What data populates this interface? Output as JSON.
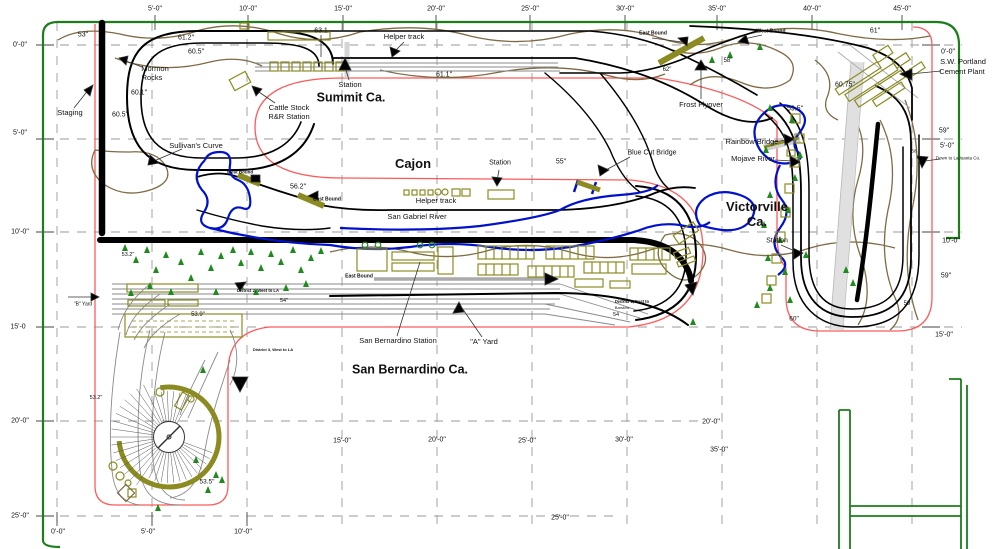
{
  "title": "Cajon Pass model railroad track plan",
  "canvas": {
    "width": 996,
    "height": 549
  },
  "colors": {
    "room_border_green": "#1b7e1b",
    "benchwork_edge_red": "#ff5a5a",
    "river_blue": "#0011cc",
    "contour_brown": "#7d6b45",
    "building_olive": "#8b8b22",
    "tree_green": "#1f8b1f",
    "track_black": "#000000",
    "grid_gray": "#909090"
  },
  "section_titles": [
    "Summit Ca.",
    "Cajon",
    "San Bernardino Ca.",
    "Victorville Ca."
  ],
  "labels": [
    {
      "id": "ruler-top-5",
      "text": "5'-0\"",
      "x": 155,
      "y": 9,
      "fs": 7
    },
    {
      "id": "ruler-top-10",
      "text": "10'-0\"",
      "x": 248,
      "y": 9,
      "fs": 7
    },
    {
      "id": "ruler-top-15",
      "text": "15'-0\"",
      "x": 343,
      "y": 9,
      "fs": 7
    },
    {
      "id": "ruler-top-20",
      "text": "20'-0\"",
      "x": 436,
      "y": 9,
      "fs": 7
    },
    {
      "id": "ruler-top-25",
      "text": "25'-0\"",
      "x": 530,
      "y": 9,
      "fs": 7
    },
    {
      "id": "ruler-top-30",
      "text": "30'-0\"",
      "x": 625,
      "y": 9,
      "fs": 7
    },
    {
      "id": "ruler-top-35",
      "text": "35'-0\"",
      "x": 717,
      "y": 9,
      "fs": 7
    },
    {
      "id": "ruler-top-40",
      "text": "40'-0\"",
      "x": 812,
      "y": 9,
      "fs": 7
    },
    {
      "id": "ruler-top-45",
      "text": "45'-0\"",
      "x": 902,
      "y": 9,
      "fs": 7
    },
    {
      "id": "ruler-left-0",
      "text": "0'-0\"",
      "x": 20,
      "y": 45,
      "fs": 7
    },
    {
      "id": "ruler-left-5",
      "text": "5'-0\"",
      "x": 20,
      "y": 133,
      "fs": 7
    },
    {
      "id": "ruler-left-10",
      "text": "10'-0\"",
      "x": 20,
      "y": 232,
      "fs": 7
    },
    {
      "id": "ruler-left-15",
      "text": "15'-0",
      "x": 18,
      "y": 327,
      "fs": 7
    },
    {
      "id": "ruler-left-20",
      "text": "20'-0\"",
      "x": 20,
      "y": 421,
      "fs": 7
    },
    {
      "id": "ruler-left-25",
      "text": "25'-0\"",
      "x": 20,
      "y": 516,
      "fs": 7
    },
    {
      "id": "ruler-bottom-0",
      "text": "0'-0\"",
      "x": 58,
      "y": 532,
      "fs": 7
    },
    {
      "id": "ruler-bottom-5",
      "text": "5'-0\"",
      "x": 148,
      "y": 532,
      "fs": 7
    },
    {
      "id": "ruler-bottom-10",
      "text": "10'-0\"",
      "x": 243,
      "y": 532,
      "fs": 7
    },
    {
      "id": "ruler-bottom-25",
      "text": "25'-0\"",
      "x": 560,
      "y": 518,
      "fs": 7
    },
    {
      "id": "ruler-mid-15",
      "text": "15'-0\"",
      "x": 342,
      "y": 441,
      "fs": 7
    },
    {
      "id": "ruler-mid-20",
      "text": "20'-0\"",
      "x": 437,
      "y": 440,
      "fs": 7
    },
    {
      "id": "ruler-mid-25",
      "text": "25'-0\"",
      "x": 527,
      "y": 441,
      "fs": 7
    },
    {
      "id": "ruler-mid-30",
      "text": "30'-0\"",
      "x": 624,
      "y": 440,
      "fs": 7
    },
    {
      "id": "ruler-mid-20b",
      "text": "20'-0\"",
      "x": 711,
      "y": 422,
      "fs": 7
    },
    {
      "id": "ruler-mid-35",
      "text": "35'-0\"",
      "x": 719,
      "y": 450,
      "fs": 7
    },
    {
      "id": "ruler-right-0",
      "text": "0'-0\"",
      "x": 948,
      "y": 52,
      "fs": 7
    },
    {
      "id": "cement-plant-line1",
      "text": "S.W. Portland",
      "x": 963,
      "y": 62,
      "fs": 7.5
    },
    {
      "id": "cement-plant-line2",
      "text": "Cement Plant",
      "x": 962,
      "y": 72,
      "fs": 7.5
    },
    {
      "id": "elev-59-right-top",
      "text": "59\"",
      "x": 944,
      "y": 131,
      "fs": 7
    },
    {
      "id": "ruler-right-5",
      "text": "5'-0\"",
      "x": 947,
      "y": 146,
      "fs": 7
    },
    {
      "id": "down-to-lajuanta",
      "text": "Down to LaJuanta Co.",
      "x": 958,
      "y": 159,
      "fs": 4.5
    },
    {
      "id": "ruler-right-10",
      "text": "10'-0\"",
      "x": 951,
      "y": 241,
      "fs": 7
    },
    {
      "id": "elev-59-right-mid",
      "text": "59\"",
      "x": 946,
      "y": 276,
      "fs": 7
    },
    {
      "id": "ruler-right-15",
      "text": "15'-0\"",
      "x": 944,
      "y": 335,
      "fs": 7
    },
    {
      "id": "elev-58-hill",
      "text": "58",
      "x": 914,
      "y": 152,
      "fs": 4.5
    },
    {
      "id": "elev-59-hill",
      "text": "59",
      "x": 907,
      "y": 304,
      "fs": 6
    },
    {
      "id": "elev-53-staging",
      "text": "53\"",
      "x": 83,
      "y": 35,
      "fs": 7
    },
    {
      "id": "elev-61-2",
      "text": "61.2\"",
      "x": 186,
      "y": 38,
      "fs": 7
    },
    {
      "id": "elev-60-5a",
      "text": "60.5\"",
      "x": 196,
      "y": 52,
      "fs": 7
    },
    {
      "id": "elev-60-1",
      "text": "60.1\"",
      "x": 139,
      "y": 93,
      "fs": 7
    },
    {
      "id": "elev-60-5b",
      "text": "60.5\"",
      "x": 120,
      "y": 115,
      "fs": 7
    },
    {
      "id": "elev-63-1",
      "text": "63.1",
      "x": 321,
      "y": 31,
      "fs": 7
    },
    {
      "id": "elev-61-1",
      "text": "61.1\"",
      "x": 444,
      "y": 75,
      "fs": 7
    },
    {
      "id": "elev-61",
      "text": "61\"",
      "x": 875,
      "y": 31,
      "fs": 7
    },
    {
      "id": "elev-60-75",
      "text": "60.75\"",
      "x": 845,
      "y": 85,
      "fs": 7
    },
    {
      "id": "elev-59-5",
      "text": "59.5\"",
      "x": 795,
      "y": 109,
      "fs": 7
    },
    {
      "id": "elev-62",
      "text": "62\"",
      "x": 667,
      "y": 70,
      "fs": 6
    },
    {
      "id": "elev-58",
      "text": "58\"",
      "x": 728,
      "y": 61,
      "fs": 6
    },
    {
      "id": "elev-56-2",
      "text": "56.2\"",
      "x": 298,
      "y": 187,
      "fs": 7
    },
    {
      "id": "elev-55",
      "text": "55\"",
      "x": 561,
      "y": 162,
      "fs": 7
    },
    {
      "id": "elev-60",
      "text": "60\"",
      "x": 794,
      "y": 320,
      "fs": 6.5
    },
    {
      "id": "elev-53-9",
      "text": "53.9\"",
      "x": 198,
      "y": 315,
      "fs": 6
    },
    {
      "id": "elev-53-2a",
      "text": "53.2\"",
      "x": 128,
      "y": 256,
      "fs": 5.5
    },
    {
      "id": "elev-53-2b",
      "text": "53.2\"",
      "x": 96,
      "y": 399,
      "fs": 5.5
    },
    {
      "id": "elev-53-5",
      "text": "53.5\"",
      "x": 207,
      "y": 483,
      "fs": 6.5
    },
    {
      "id": "elev-54a",
      "text": "54\"",
      "x": 284,
      "y": 302,
      "fs": 5.5
    },
    {
      "id": "elev-54b",
      "text": "54",
      "x": 616,
      "y": 316,
      "fs": 5.5
    },
    {
      "id": "staging",
      "text": "Staging",
      "x": 70,
      "y": 113,
      "fs": 7.5
    },
    {
      "id": "mormon-rocks-1",
      "text": "Mormon",
      "x": 155,
      "y": 69,
      "fs": 7.5
    },
    {
      "id": "mormon-rocks-2",
      "text": "Rocks",
      "x": 152,
      "y": 78,
      "fs": 7.5
    },
    {
      "id": "sullivans-curve",
      "text": "Sullivan's Curve",
      "x": 196,
      "y": 146,
      "fs": 7.5
    },
    {
      "id": "cattle-stock-1",
      "text": "Cattle Stock",
      "x": 289,
      "y": 108,
      "fs": 7.5
    },
    {
      "id": "cattle-stock-2",
      "text": "R&R Station",
      "x": 289,
      "y": 117,
      "fs": 7.5
    },
    {
      "id": "summit-ca",
      "text": "Summit Ca.",
      "x": 351,
      "y": 98,
      "fs": 12.5,
      "bold": true
    },
    {
      "id": "summit-station",
      "text": "Station",
      "x": 350,
      "y": 85,
      "fs": 7.5
    },
    {
      "id": "helper-track-summit",
      "text": "Helper track",
      "x": 404,
      "y": 37,
      "fs": 7.5
    },
    {
      "id": "cajon",
      "text": "Cajon",
      "x": 413,
      "y": 164,
      "fs": 13,
      "bold": true
    },
    {
      "id": "cajon-station",
      "text": "Station",
      "x": 500,
      "y": 163,
      "fs": 7
    },
    {
      "id": "blue-cut-bridge",
      "text": "Blue Cut Bridge",
      "x": 652,
      "y": 153,
      "fs": 7
    },
    {
      "id": "helper-track-cajon",
      "text": "Helper track",
      "x": 436,
      "y": 201,
      "fs": 7.5
    },
    {
      "id": "san-gabriel-river",
      "text": "San Gabriel River",
      "x": 417,
      "y": 217,
      "fs": 7.5
    },
    {
      "id": "west-bound-cajon",
      "text": "West Bound",
      "x": 240,
      "y": 173,
      "fs": 4.5,
      "bold": true
    },
    {
      "id": "east-bound-cajon",
      "text": "East Bound",
      "x": 327,
      "y": 200,
      "fs": 5,
      "bold": true
    },
    {
      "id": "east-bound-sb",
      "text": "East Bound",
      "x": 359,
      "y": 277,
      "fs": 5,
      "bold": true
    },
    {
      "id": "san-bernardino-station",
      "text": "San Bernardino Station",
      "x": 398,
      "y": 341,
      "fs": 7.5
    },
    {
      "id": "a-yard",
      "text": "\"A\" Yard",
      "x": 484,
      "y": 342,
      "fs": 7.5
    },
    {
      "id": "san-bernardino-ca",
      "text": "San Bernardino Ca.",
      "x": 410,
      "y": 370,
      "fs": 12.5,
      "bold": true
    },
    {
      "id": "b-yard",
      "text": "\"B\" Yard",
      "x": 83,
      "y": 305,
      "fs": 5
    },
    {
      "id": "district-2",
      "text": "District 2, West to LA",
      "x": 258,
      "y": 291,
      "fs": 4.2,
      "bold": true
    },
    {
      "id": "district-3",
      "text": "District 3, West to LA",
      "x": 273,
      "y": 350,
      "fs": 4,
      "bold": true
    },
    {
      "id": "district-1",
      "text": "District 1, East to",
      "x": 632,
      "y": 302,
      "fs": 4.2,
      "bold": true
    },
    {
      "id": "district-1b",
      "text": "Barstow",
      "x": 622,
      "y": 308,
      "fs": 4
    },
    {
      "id": "east-bound-top",
      "text": "East Bound",
      "x": 653,
      "y": 34,
      "fs": 5,
      "bold": true
    },
    {
      "id": "west-bound-top",
      "text": "West Bound",
      "x": 771,
      "y": 32,
      "fs": 5,
      "bold": true
    },
    {
      "id": "frost-flyover",
      "text": "Frost Flyover",
      "x": 701,
      "y": 105,
      "fs": 7.5
    },
    {
      "id": "rainbow-bridge",
      "text": "Rainbow Bridge",
      "x": 752,
      "y": 142,
      "fs": 7.5
    },
    {
      "id": "mojave-river",
      "text": "Mojave River",
      "x": 753,
      "y": 159,
      "fs": 7.5
    },
    {
      "id": "victorville-ca-1",
      "text": "Victorville",
      "x": 757,
      "y": 207,
      "fs": 13,
      "bold": true
    },
    {
      "id": "victorville-ca-2",
      "text": "Ca.",
      "x": 757,
      "y": 222,
      "fs": 13,
      "bold": true
    },
    {
      "id": "victorville-station",
      "text": "Station",
      "x": 777,
      "y": 241,
      "fs": 7
    }
  ]
}
